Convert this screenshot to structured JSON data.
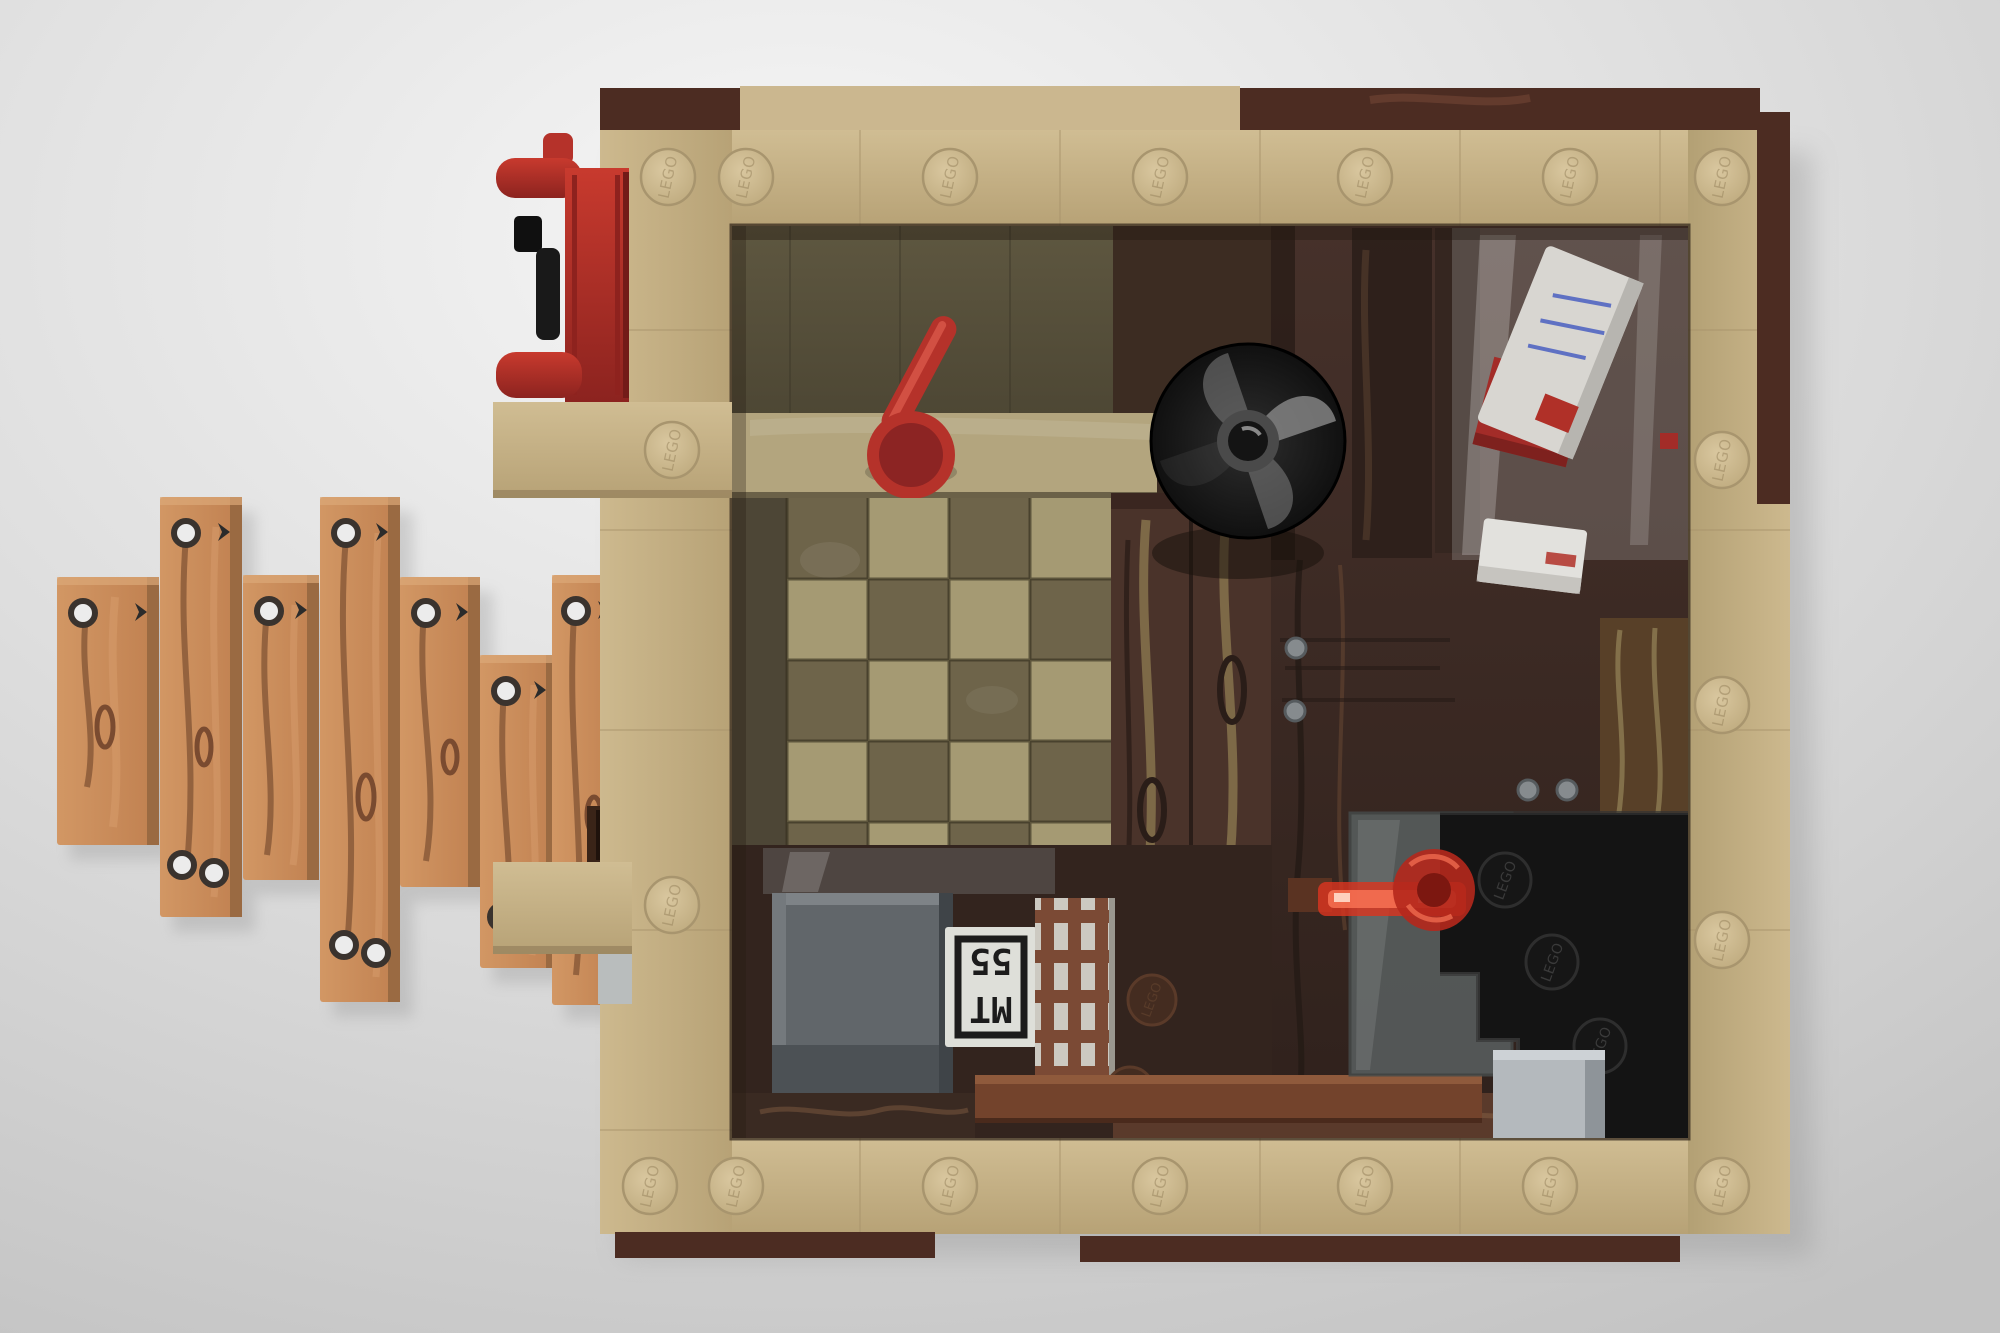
{
  "scene": {
    "description": "Top-down 3D CGI render of a LEGO interior room module: a square tan brick frame with embossed LEGO studs, dark brown trim bricks outside, a stepped walkway of nailed wooden planks on the left, a red water pump on the upper-left exterior wall, and an interior containing an olive checkerboard tile floor, a tan counter with a red mug, a black dish pan, dark wood-grain plank partitions, an envelope rack with a white letter (blue address lines, red stamp), a gray crate with an upside-down MT55 printed tile, a brown lattice fence piece, a reddish bench, a translucent red lever and a black stepped staircase with a light gray step in the bottom-right corner.",
    "view": "top-down",
    "render_style": "3D brick model render on gray studio background"
  },
  "branding": {
    "stud_text": "LEGO"
  },
  "crate_print": {
    "line1": "MT",
    "line2": "55",
    "orientation": "upside-down"
  },
  "palette": {
    "background_light": "#f6f6f6",
    "background_dark": "#c3c3c3",
    "tan_wall": "#c7b185",
    "tan_parapet": "#cbb78f",
    "dark_brown_trim": "#4c2c22",
    "olive_wall": "#56503a",
    "checker_dark": "#6e644a",
    "checker_light": "#a59a73",
    "plank_wood": "#c98a59",
    "plank_grain": "#8a5a38",
    "counter_tan": "#b3a57e",
    "red": "#b5322a",
    "trans_red": "#d93420",
    "dish_black": "#141414",
    "glass_gray": "#596060",
    "step_gray": "#b4b9bd",
    "box_gray": "#61666a",
    "envelope_white": "#d8d6d1",
    "envelope_lines_blue": "#4a5fc1",
    "floor_brown": "#3c2c22"
  },
  "objects": {
    "frame": "square tan brick room frame with studs",
    "outer_trim": "dark brown bricks along top, right and bottom outer edges",
    "plank_steps": "seven nailed wooden planks forming a stepped walkway, left exterior",
    "pump": "red water pump with black handle and piston, top-left exterior",
    "ledges": "two tan exterior ledges on the left wall",
    "counter": "tan counter band along the upper-left interior",
    "mug": "red mug with stick handle standing on the counter",
    "dish": "black round dish pan with gray pinwheel sheen and center hub",
    "checker_floor": "olive and khaki checkerboard tile floor",
    "plank_wall": "dark brown wood-grain plank partition in room center",
    "envelope_rack": "smoked glass rack holding a white envelope with blue lines and red stamp over a red tile, plus a second white envelope",
    "crate": "dark gray crate with white printed MT55 tile shown upside down",
    "lattice": "reddish-brown lattice fence piece on light backing",
    "gray_box": "dark gray box in the bottom-left interior",
    "bench": "reddish-brown bench along the bottom interior",
    "stairs": "black stepped staircase with embossed studs, bottom-right",
    "glass_landing": "translucent smoke-gray landing panel over the stairs",
    "gray_step": "light gray step at the bottom-right corner",
    "trans_red_lever": "translucent red bar and disc lying on the stairs",
    "knobs": "small gray round knobs on the brown cabinet fronts"
  }
}
